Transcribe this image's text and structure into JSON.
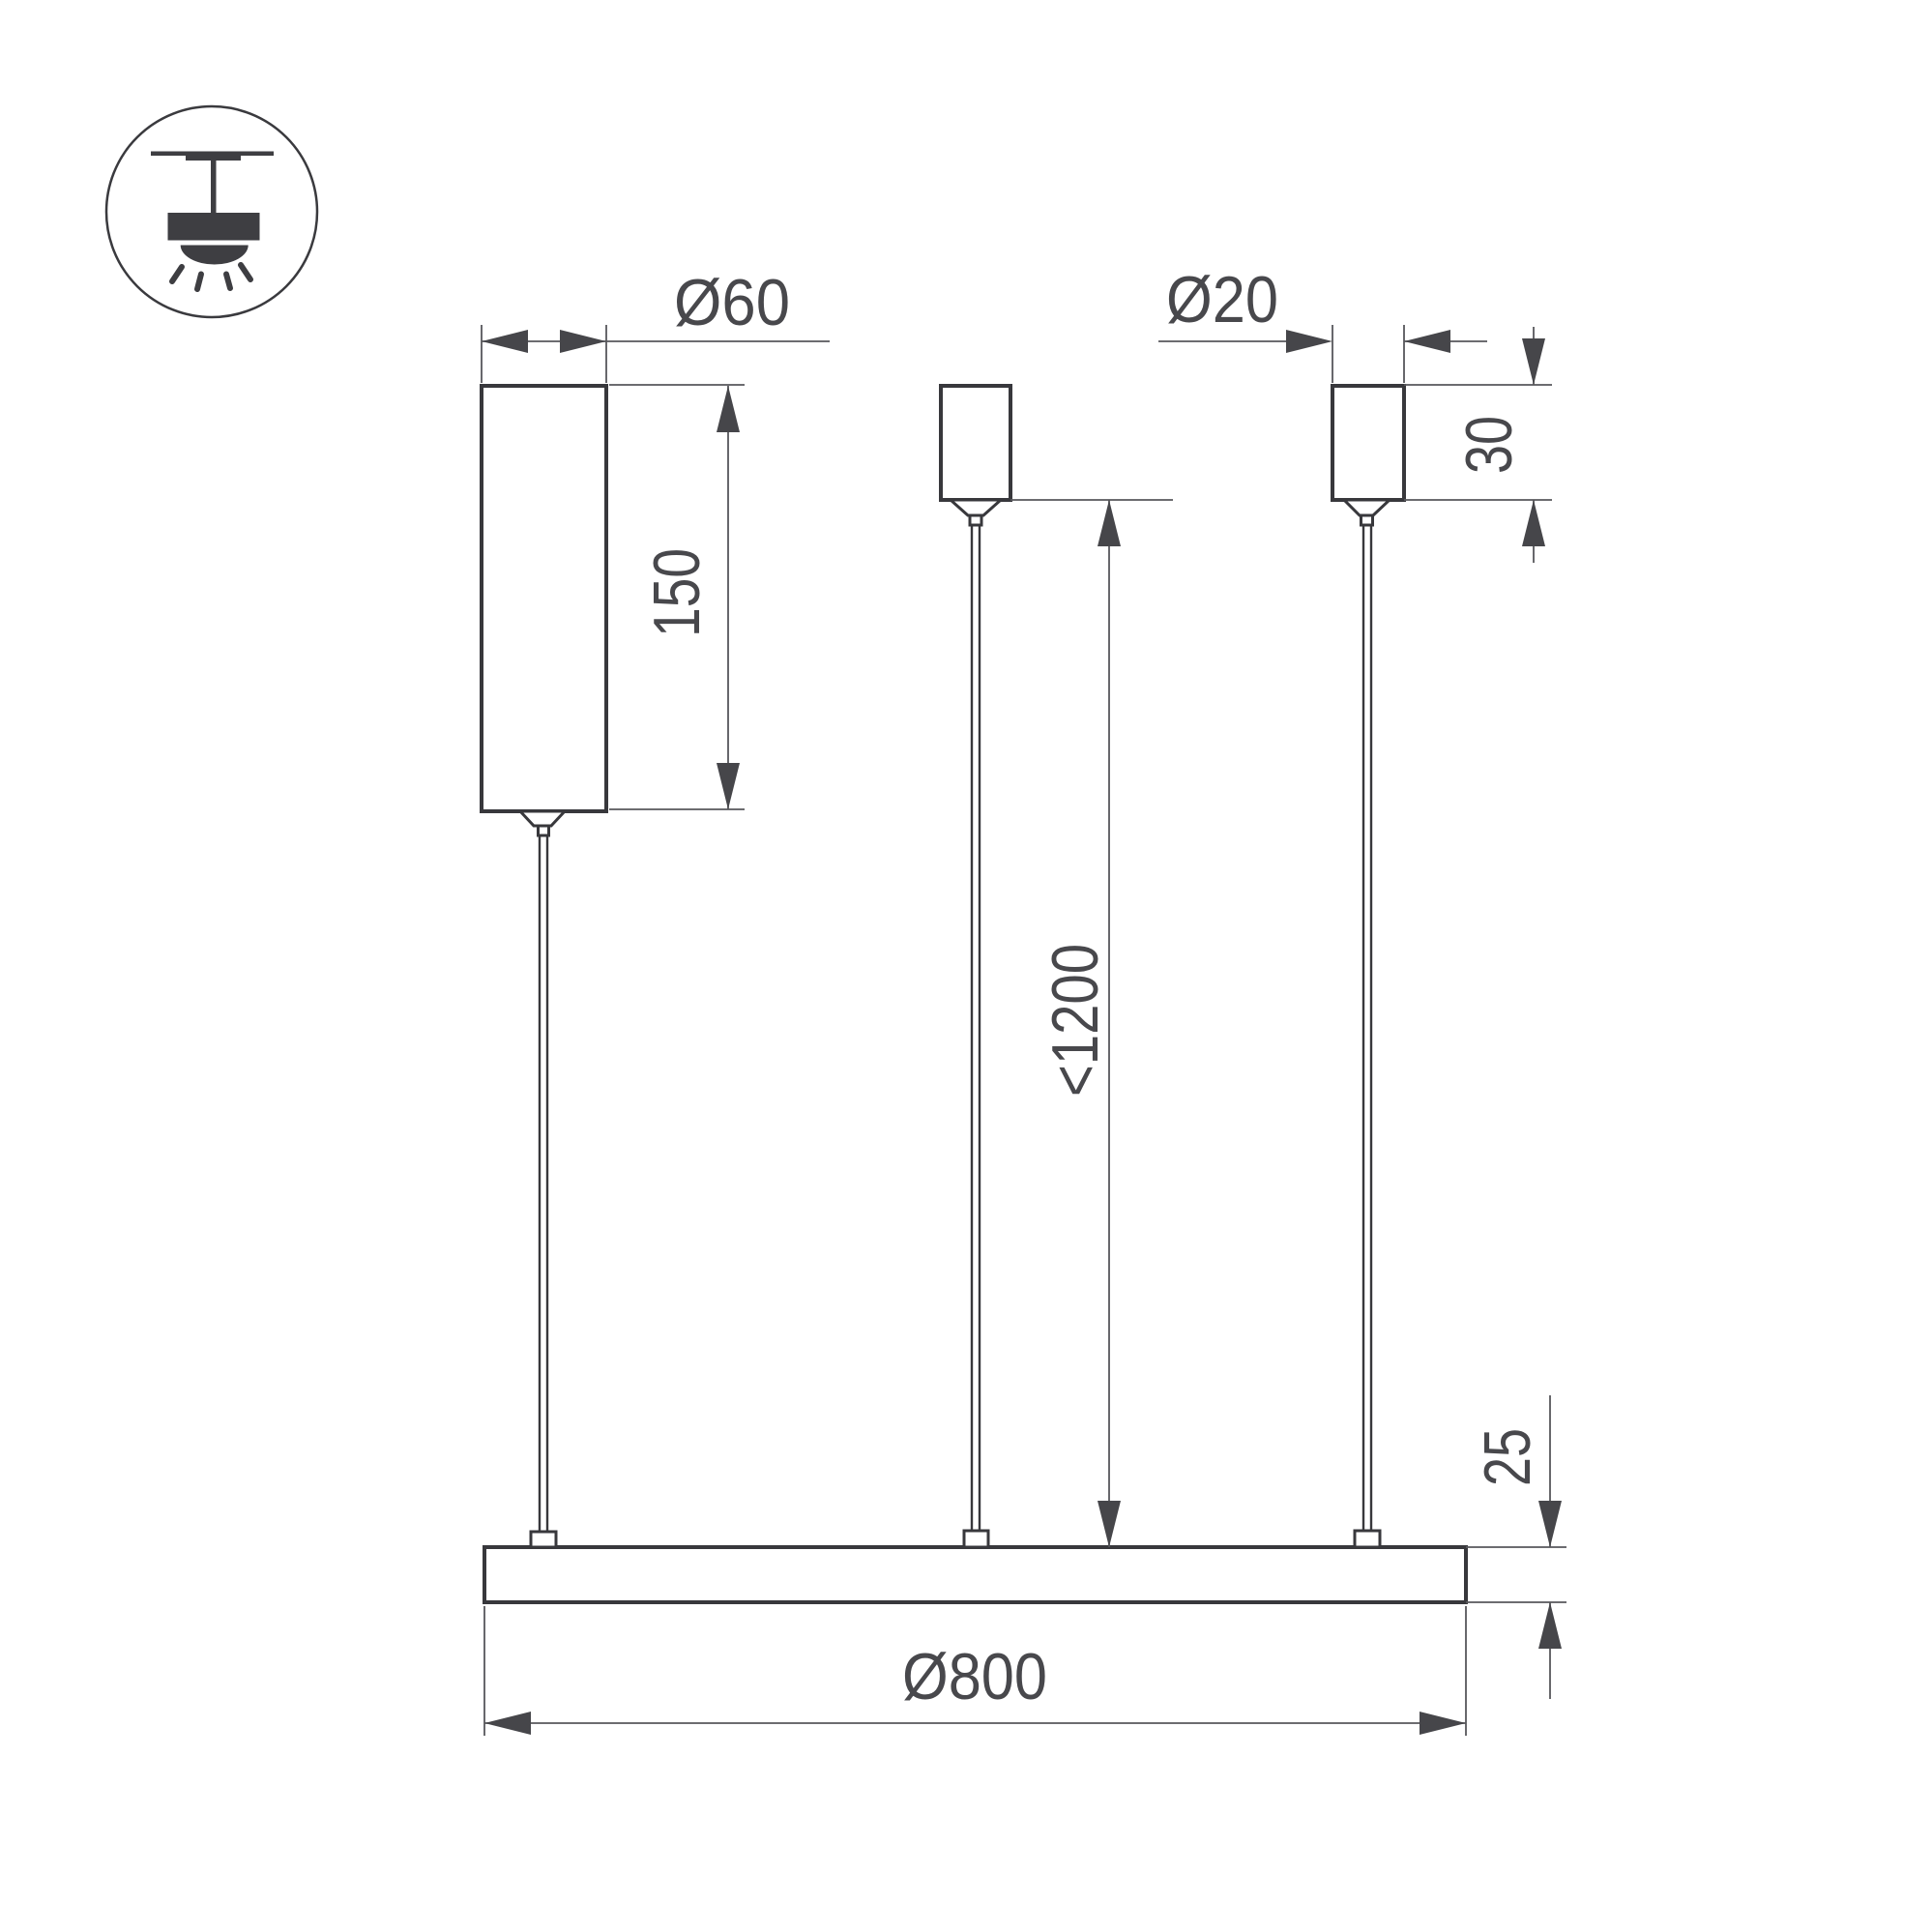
{
  "drawing": {
    "title": "suspended-luminaire-dimension-drawing",
    "icon": "pendant-ceiling-mount-icon",
    "colors": {
      "background": "#ffffff",
      "outline": "#38383c",
      "dimension_line": "#58585c",
      "annotation_text": "#48484c"
    },
    "labels": {
      "driver_diameter": "Ø60",
      "driver_length": "150",
      "canopy_diameter": "Ø20",
      "canopy_height": "30",
      "suspension_length": "<1200",
      "ring_diameter": "Ø800",
      "profile_height": "25"
    }
  }
}
